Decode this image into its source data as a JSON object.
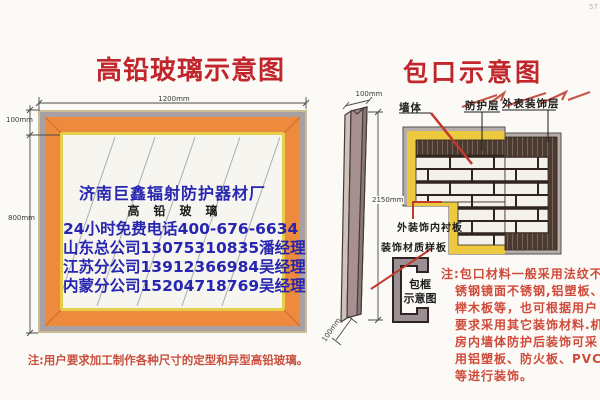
{
  "page": {
    "corner_mark": "57"
  },
  "left": {
    "title": "高铅玻璃示意图",
    "dim_width": "1200mm",
    "dim_frame": "100mm",
    "dim_height": "800mm",
    "glass": {
      "company": "济南巨鑫辐射防护器材厂",
      "product": "高铅玻璃",
      "hotline": "24小时免费电话400-676-6634",
      "branch_shandong": "山东总公司13075310835潘经理",
      "branch_jiangsu": "江苏分公司13912366984吴经理",
      "branch_neimeng": "内蒙分公司15204718769吴经理"
    },
    "note": "注:用户要求加工制作各种尺寸的定型和异型高铅玻璃。"
  },
  "right": {
    "title": "包口示意图",
    "labels": {
      "wall": "墙体",
      "protective_layer": "防护层",
      "outer_finish": "外表装饰层",
      "inner_lining": "外装饰内衬板",
      "material_sample": "装饰材质样板",
      "frame_profile_l1": "包框",
      "frame_profile_l2": "示意图"
    },
    "dims": {
      "bar_top": "100mm",
      "bar_height": "2150mm",
      "bar_bottom": "100mm"
    },
    "note": "注:包口材料一般采用法纹不锈钢镜面不锈钢,铝塑板、榉木板等，也可根据用户要求采用其它装饰材料.机房内墙体防护后装饰可采用铝塑板、防火板、PVC等进行装饰。"
  },
  "colors": {
    "title_red": "#c0262c",
    "text_blue": "#2626b0",
    "note_red": "#cf4a3a",
    "frame_orange": "#ee8a3d",
    "lead_yellow": "#ecc93f",
    "band_dark": "#4b3a30",
    "skin_gray": "#b6adaa"
  }
}
